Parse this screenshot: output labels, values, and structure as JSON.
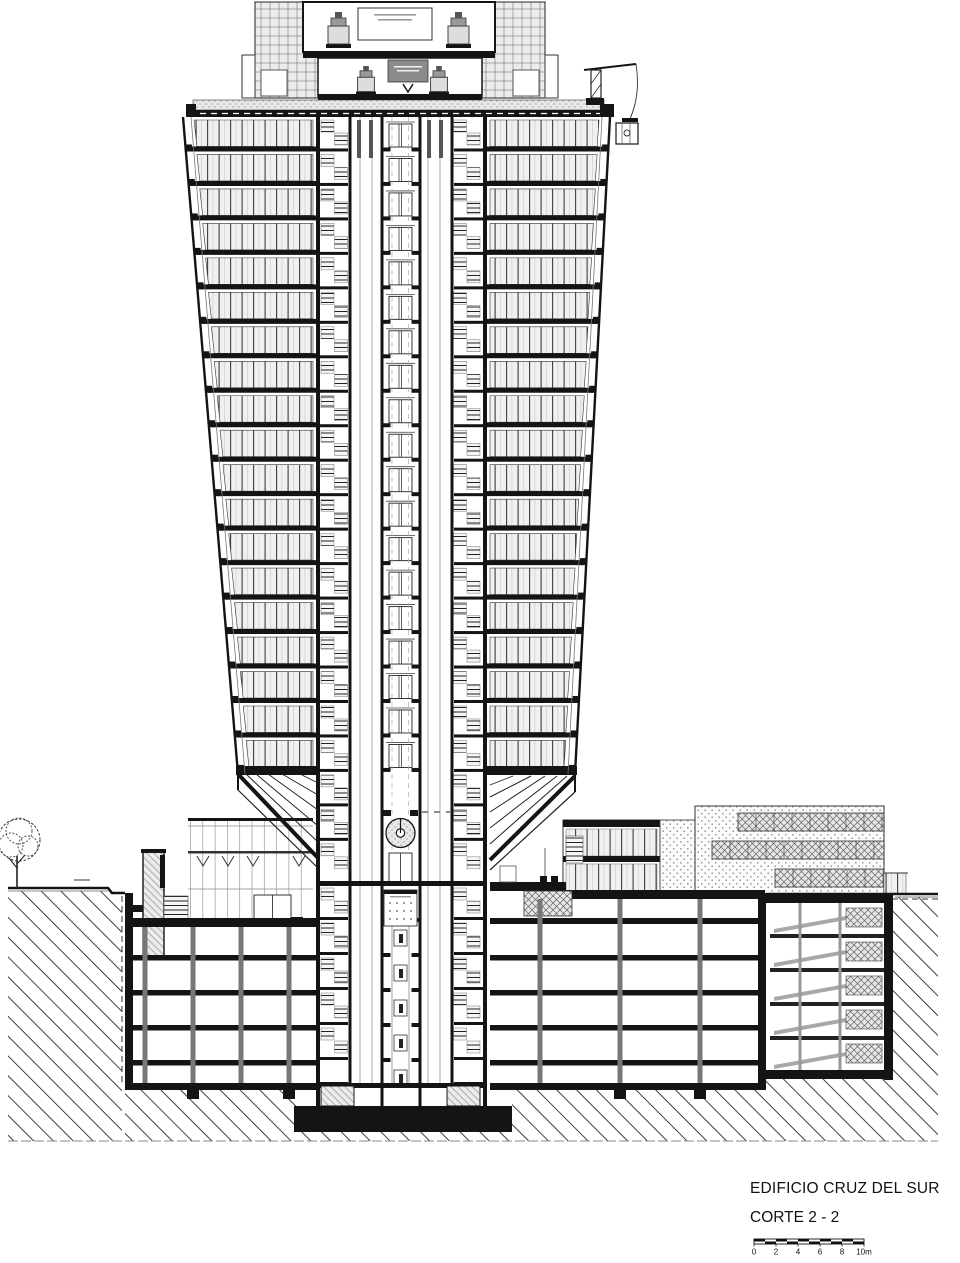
{
  "sheet": {
    "background": "#ffffff"
  },
  "title_block": {
    "project_name": "EDIFICIO CRUZ DEL SUR",
    "drawing_name": "CORTE 2 - 2"
  },
  "scale_bar": {
    "tick_labels": [
      "0",
      "2",
      "4",
      "6",
      "8",
      "10m"
    ],
    "length_meters": 10,
    "meters_per_segment": 2
  },
  "building": {
    "tower_office_floors": 19,
    "basement_levels": 6,
    "core_shafts": [
      "stair-west",
      "elevator-bank-west",
      "central-elevator-shaft",
      "elevator-bank-east",
      "stair-east"
    ],
    "roof_equipment": [
      "elevator-machine-room",
      "window-washing-crane"
    ],
    "ground_features": [
      "tree",
      "street-level-line",
      "excavated-earth-hatch"
    ],
    "lobby_features": [
      "circular-clock",
      "entrance-lobby"
    ]
  },
  "colors": {
    "ink": "#141414",
    "paper": "#ffffff",
    "dark_gray": "#555555",
    "mid_gray": "#8c8c8c",
    "light_gray": "#d9d9d9",
    "panel_fill": "#f1f1f1"
  }
}
